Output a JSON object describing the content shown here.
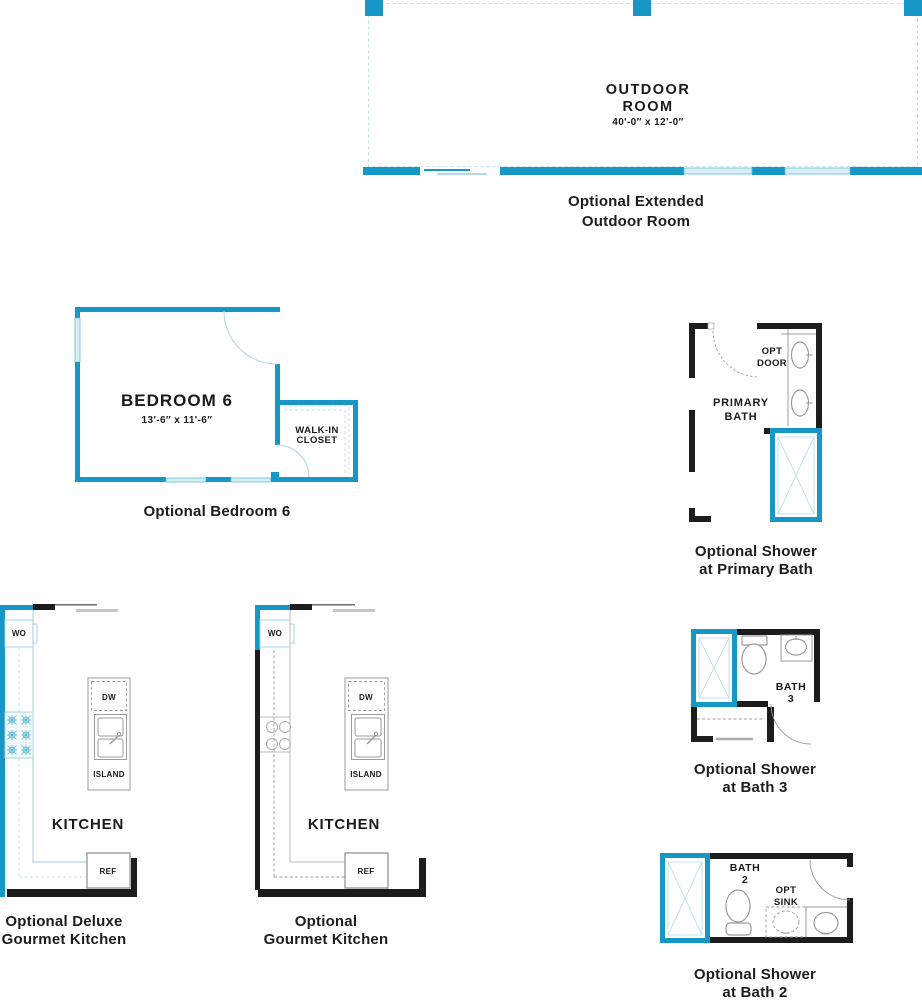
{
  "colors": {
    "wall_teal": "#1697c5",
    "wall_black": "#1c1c1c",
    "window_light_blue": "#d9edf5",
    "arc_light_blue": "#a9d7e8",
    "fixture_gray": "#9b9b9b"
  },
  "outdoor": {
    "title1": "OUTDOOR",
    "title2": "ROOM",
    "dims": "40'-0″ x 12'-0″",
    "caption1": "Optional Extended",
    "caption2": "Outdoor Room"
  },
  "bedroom6": {
    "title": "BEDROOM 6",
    "dims": "13'-6″ x 11'-6″",
    "closet1": "WALK-IN",
    "closet2": "CLOSET",
    "caption": "Optional Bedroom 6"
  },
  "primary_bath": {
    "opt_door1": "OPT",
    "opt_door2": "DOOR",
    "label1": "PRIMARY",
    "label2": "BATH",
    "caption1": "Optional Shower",
    "caption2": "at Primary Bath"
  },
  "kitchen": {
    "wo": "WO",
    "dw": "DW",
    "island": "ISLAND",
    "room": "KITCHEN",
    "ref": "REF"
  },
  "deluxe_kitchen": {
    "caption1": "Optional Deluxe",
    "caption2": "Gourmet Kitchen"
  },
  "gourmet_kitchen": {
    "caption1": "Optional",
    "caption2": "Gourmet Kitchen"
  },
  "bath3": {
    "label1": "BATH",
    "label2": "3",
    "caption1": "Optional Shower",
    "caption2": "at Bath 3"
  },
  "bath2": {
    "label1": "BATH",
    "label2": "2",
    "opt_sink1": "OPT",
    "opt_sink2": "SINK",
    "caption1": "Optional Shower",
    "caption2": "at Bath 2"
  }
}
